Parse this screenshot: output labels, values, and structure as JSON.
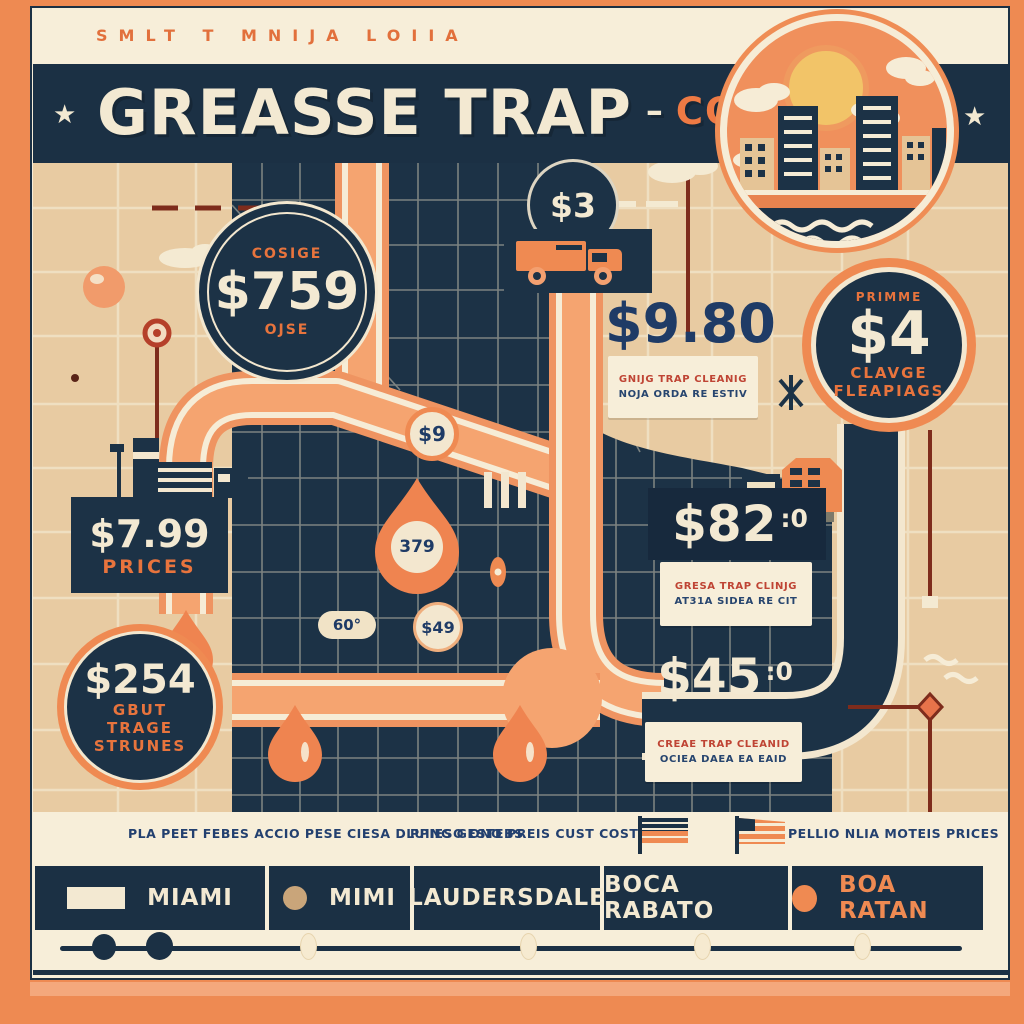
{
  "header": {
    "kicker": "SMLT T MNIJA LOIIA",
    "title": "GREASSE TRAP",
    "separator": "–",
    "subtitle": "COST",
    "star": "★"
  },
  "map": {
    "bubble_759": {
      "top": "COSIGE",
      "price": "$759",
      "bottom": "OJSE"
    },
    "truck_price": "$3",
    "price_980": {
      "price": "$9.80",
      "note_line1": "GNIJG TRAP CLEANIG",
      "note_line2": "NOJA ORDA RE ESTIV"
    },
    "bubble_4": {
      "top": "PRIMME",
      "price": "$4",
      "line1": "CLAVGE",
      "line2": "FLEAPIAGS"
    },
    "badge_799": {
      "price": "$7.99",
      "label": "PRICES"
    },
    "bubble_254": {
      "price": "$254",
      "line1": "GBUT",
      "line2": "TRAGE",
      "line3": "STRUNES"
    },
    "price_82": {
      "price": "$82",
      "suffix": ":0",
      "note_line1": "GRESA TRAP CLINJG",
      "note_line2": "AT31A SIDEA RE CIT"
    },
    "price_45": {
      "price": "$45",
      "suffix": ":0",
      "note_line1": "CREAE TRAP CLEANID",
      "note_line2": "OCIEA DAEA EA EAID"
    },
    "marker_9": "$9",
    "marker_379": "379",
    "marker_60": "60°",
    "marker_49": "$49"
  },
  "footer": {
    "notes": [
      {
        "text": "PLA PEET FEBES ACCIO PESE CIESA DLUING GESTEBS"
      },
      {
        "text": "PPIESO ONO PREIS CUST COSTES"
      },
      {
        "text": "PELLIO NLIA MOTEIS PRICES"
      }
    ],
    "legend": [
      {
        "label": "MIAMI"
      },
      {
        "label": "MIMI"
      },
      {
        "label": "LAUDERSDALE"
      },
      {
        "label": "BOCA RABATO"
      },
      {
        "label": "BOA RATAN"
      }
    ]
  },
  "colors": {
    "navy": "#1c3246",
    "orange": "#ef8a52",
    "cream": "#f7eed9",
    "tan": "#e8cba2",
    "dark_red": "#7e2c1c",
    "red_text": "#bf4434",
    "blue_text": "#1f3b66"
  }
}
